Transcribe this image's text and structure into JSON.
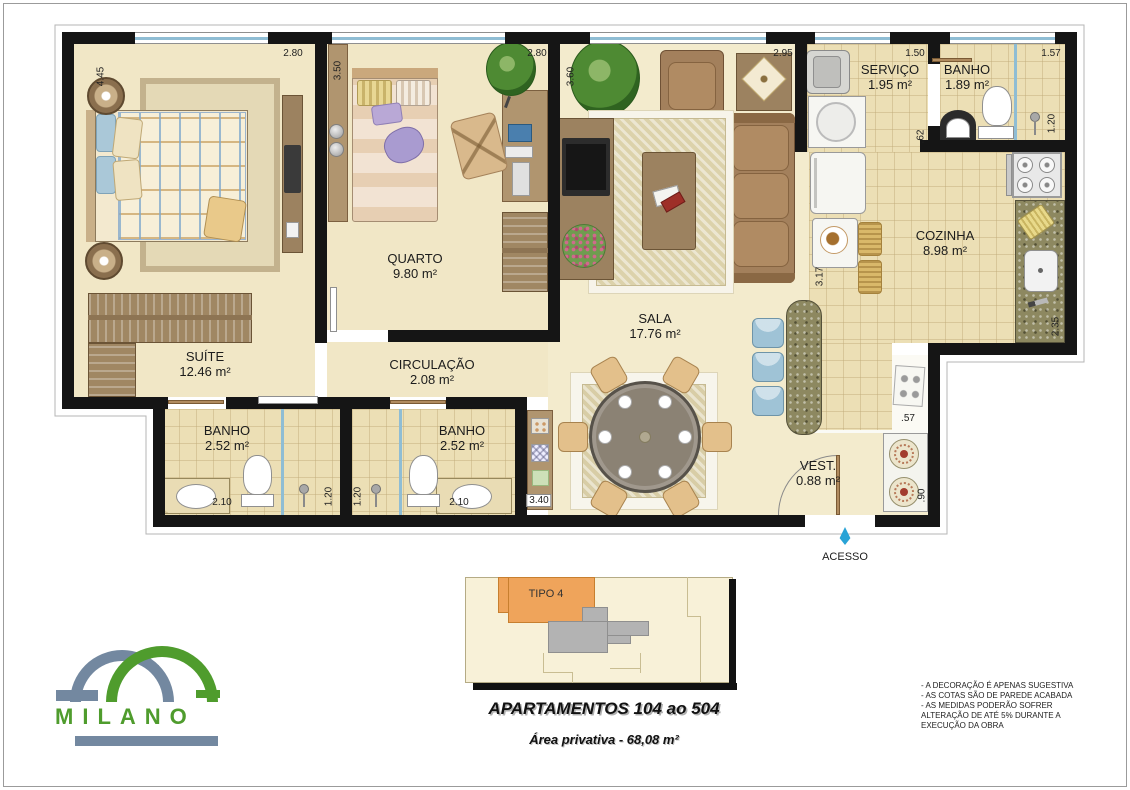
{
  "plan": {
    "rooms": {
      "suite": {
        "name": "SUÍTE",
        "area": "12.46 m²"
      },
      "quarto": {
        "name": "QUARTO",
        "area": "9.80 m²"
      },
      "circulacao": {
        "name": "CIRCULAÇÃO",
        "area": "2.08 m²"
      },
      "banho_suite": {
        "name": "BANHO",
        "area": "2.52 m²"
      },
      "banho_social": {
        "name": "BANHO",
        "area": "2.52 m²"
      },
      "sala": {
        "name": "SALA",
        "area": "17.76 m²"
      },
      "cozinha": {
        "name": "COZINHA",
        "area": "8.98 m²"
      },
      "servico": {
        "name": "SERVIÇO",
        "area": "1.95 m²"
      },
      "banho_servico": {
        "name": "BANHO",
        "area": "1.89 m²"
      },
      "vest": {
        "name": "VEST.",
        "area": "0.88 m²"
      }
    },
    "dims": {
      "suite_height": "4.45",
      "suite_width": "2.80",
      "quarto_height": "3.50",
      "quarto_width": "2.80",
      "sala_height": "3.60",
      "sala_width": "2.95",
      "servico_width": "1.50",
      "banho_servico_width": "1.57",
      "servico_opening": ".62",
      "banho_servico_shower": "1.20",
      "cozinha_height": "3.17",
      "bancada": "2.35",
      "apoio": ".57",
      "nicho": ".90",
      "armario": "3.40",
      "banho_suite_bancada": "2.10",
      "banho_suite_box": "1.20",
      "banho_social_box": "1.20",
      "banho_social_bancada": "2.10"
    },
    "access_label": "ACESSO"
  },
  "footer": {
    "brand": "MILANO",
    "key_plan_unit": "TIPO 4",
    "title": "APARTAMENTOS 104 ao 504",
    "subtitle": "Área privativa - 68,08 m²",
    "notes": [
      "- A DECORAÇÃO É APENAS SUGESTIVA",
      "- AS COTAS SÃO DE PAREDE ACABADA",
      "- AS MEDIDAS PODERÃO SOFRER",
      "ALTERAÇÃO DE ATÉ 5% DURANTE A",
      "EXECUÇÃO DA OBRA"
    ]
  },
  "colors": {
    "accent_orange": "#EFA45B",
    "logo_green": "#4F9C2D",
    "logo_gray": "#7388A0",
    "window_blue": "#8FBDD4"
  }
}
